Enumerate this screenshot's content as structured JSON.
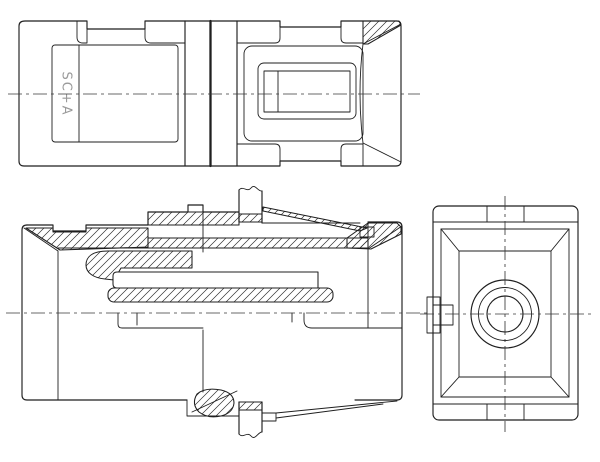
{
  "drawing": {
    "label": "SC+A",
    "colors": {
      "line": "#1f1f1f",
      "background": "#ffffff",
      "engraving": "#9a9a9a",
      "centerline": "#3a3a3a"
    },
    "views": {
      "top": "top-view",
      "front_section": "front-section-view",
      "side": "side-view"
    }
  }
}
